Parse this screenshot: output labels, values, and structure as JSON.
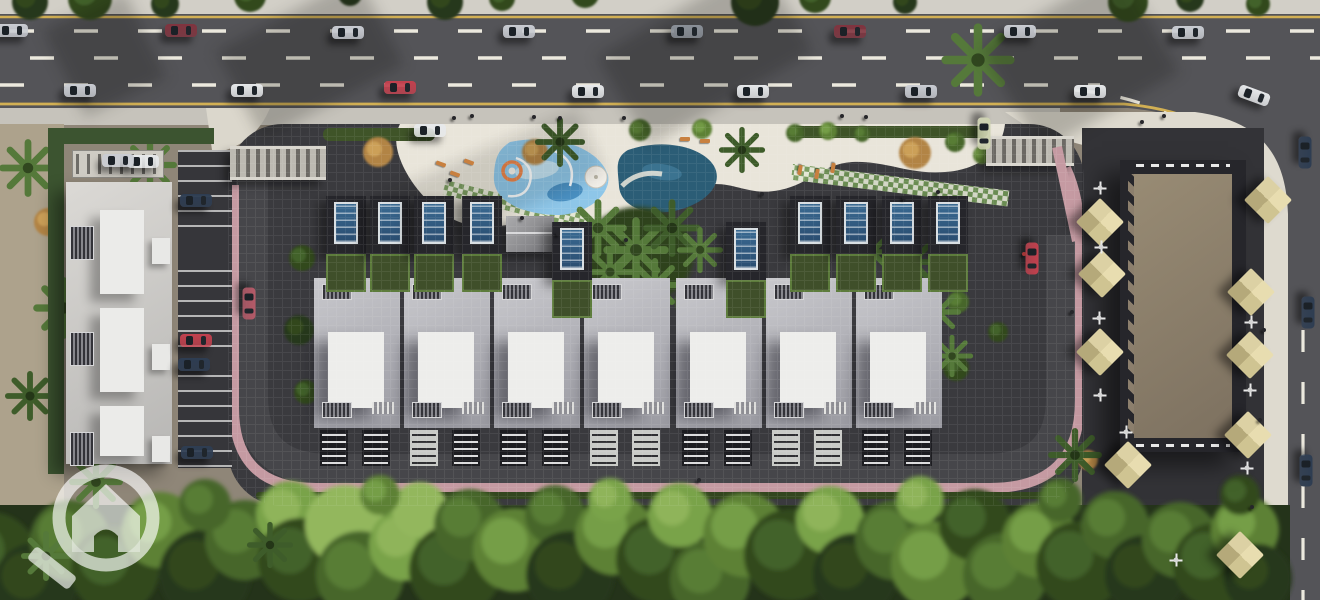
{
  "scene": {
    "title": "Residential compound aerial master-plan 3D render",
    "view": "top-down bird's eye",
    "elements": "main road with traffic, gated villa compound with two pools, apartment block with parking, retail building with cafe umbrellas, tree belt"
  },
  "palette": {
    "road": "#545458",
    "road_service": "#4b4b4f",
    "lane_marking": "#ece9de",
    "edge_line": "#d2b054",
    "sidewalk_top": "#d2cfc7",
    "sidewalk_bottom": "#c6c3bb",
    "walk_wedge": "#dedacf",
    "sand": "#ada28c",
    "compound_paving": "#3a3a3e",
    "inner_road": "#46464a",
    "pink_walk": "#c59aa2",
    "deck": "#e9e5da",
    "hedge": "#3f5428",
    "pool_kids": "#8ec6e8",
    "pool_kids_light": "#c2e2f2",
    "pool_kids_deep": "#4a90c2",
    "pool_main": "#2b5d76",
    "pool_main_light": "#3b7390",
    "checker_a": "#e3e7d4",
    "checker_b": "#6f9554",
    "tree_base": "#24331a",
    "umbrella": "#d8cd9e",
    "watermark": "rgba(255,255,255,0.8)"
  },
  "watermark": {
    "icon": "magnifier-house-logo",
    "position": "bottom-left"
  },
  "main_road": {
    "lanes": 4,
    "orientation": "horizontal",
    "edge_lines": "yellow",
    "lane_dashes": "white"
  },
  "service_road": {
    "orientation": "vertical",
    "position": "right-edge"
  },
  "compound": {
    "gates": 2,
    "villas": {
      "count": 7,
      "y": 278,
      "x_positions": [
        314,
        404,
        494,
        584,
        676,
        766,
        856
      ]
    },
    "solar_units": [
      [
        326,
        196
      ],
      [
        370,
        196
      ],
      [
        414,
        196
      ],
      [
        462,
        196
      ],
      [
        552,
        222
      ],
      [
        726,
        222
      ],
      [
        790,
        196
      ],
      [
        836,
        196
      ],
      [
        882,
        196
      ],
      [
        928,
        196
      ]
    ],
    "pools": [
      {
        "name": "kids-aqua-pool",
        "color": "#8ec6e8",
        "features": [
          "slides",
          "spiral-ring"
        ]
      },
      {
        "name": "main-pool",
        "color": "#2b5d76"
      }
    ],
    "cabana": true,
    "white_parasol": [
      596,
      177
    ]
  },
  "vehicles": {
    "car_colors": [
      "#c9ccd2",
      "#e6e8ea",
      "#80343f",
      "#c2414e",
      "#2e3d52",
      "#8a9098",
      "#cdd2b0",
      "#b55a68"
    ],
    "main_road": [
      [
        12,
        30,
        0,
        0
      ],
      [
        181,
        30,
        0,
        2
      ],
      [
        348,
        32,
        0,
        0
      ],
      [
        519,
        31,
        0,
        0
      ],
      [
        687,
        31,
        0,
        5
      ],
      [
        850,
        31,
        0,
        2
      ],
      [
        1020,
        31,
        0,
        0
      ],
      [
        1188,
        32,
        0,
        0
      ],
      [
        80,
        90,
        0,
        0
      ],
      [
        247,
        90,
        0,
        1
      ],
      [
        400,
        87,
        0,
        3
      ],
      [
        588,
        91,
        0,
        1
      ],
      [
        753,
        91,
        0,
        1
      ],
      [
        921,
        91,
        0,
        0
      ],
      [
        1090,
        91,
        0,
        1
      ],
      [
        1254,
        95,
        20,
        1
      ]
    ],
    "service_road": [
      [
        1305,
        152,
        90,
        4
      ],
      [
        1308,
        312,
        90,
        4
      ],
      [
        1306,
        470,
        90,
        4
      ]
    ],
    "compound": [
      [
        249,
        303,
        90,
        7
      ],
      [
        1032,
        258,
        90,
        3
      ],
      [
        984,
        133,
        90,
        6
      ],
      [
        430,
        130,
        0,
        1
      ]
    ],
    "parking": [
      [
        196,
        200,
        0,
        4
      ],
      [
        196,
        340,
        0,
        3
      ],
      [
        194,
        364,
        0,
        4
      ],
      [
        197,
        452,
        0,
        4
      ],
      [
        143,
        161,
        0,
        1
      ],
      [
        118,
        160,
        0,
        0
      ]
    ]
  },
  "commercial": {
    "roof_color": "#8c7f6d",
    "umbrellas": [
      [
        1100,
        222
      ],
      [
        1102,
        274
      ],
      [
        1100,
        352
      ],
      [
        1128,
        465
      ],
      [
        1251,
        292
      ],
      [
        1250,
        355
      ],
      [
        1248,
        435
      ],
      [
        1240,
        555
      ],
      [
        1268,
        200
      ]
    ],
    "tables": [
      [
        1100,
        188
      ],
      [
        1101,
        247
      ],
      [
        1099,
        318
      ],
      [
        1100,
        395
      ],
      [
        1126,
        432
      ],
      [
        1251,
        322
      ],
      [
        1250,
        390
      ],
      [
        1247,
        468
      ],
      [
        1176,
        560
      ]
    ]
  },
  "people": [
    [
      452,
      116,
      0
    ],
    [
      470,
      114,
      0
    ],
    [
      532,
      115,
      0
    ],
    [
      558,
      116,
      0
    ],
    [
      622,
      116,
      0
    ],
    [
      840,
      114,
      0
    ],
    [
      864,
      115,
      0
    ],
    [
      1162,
      114,
      0
    ],
    [
      448,
      178,
      0
    ],
    [
      520,
      216,
      0
    ],
    [
      556,
      232,
      0
    ],
    [
      624,
      238,
      0
    ],
    [
      760,
      192,
      0
    ],
    [
      902,
      196,
      0
    ],
    [
      1022,
      252,
      1
    ],
    [
      1070,
      310,
      0
    ],
    [
      1262,
      328,
      0
    ],
    [
      1258,
      418,
      0
    ],
    [
      1250,
      505,
      0
    ],
    [
      697,
      478,
      0
    ],
    [
      1140,
      120,
      0
    ],
    [
      936,
      190,
      0
    ]
  ],
  "loungers": [
    [
      436,
      162,
      20
    ],
    [
      450,
      172,
      20
    ],
    [
      464,
      160,
      20
    ],
    [
      795,
      168,
      100
    ],
    [
      812,
      172,
      100
    ],
    [
      828,
      166,
      100
    ],
    [
      680,
      137,
      0
    ],
    [
      700,
      139,
      0
    ]
  ],
  "vegetation": {
    "tree_colors": [
      "#26381b",
      "#33491f",
      "#47662b",
      "#5d8136",
      "#79a349",
      "#93b75d"
    ],
    "autumn_color": "#b28445",
    "bottom_trees": [
      [
        -10,
        560,
        48,
        1
      ],
      [
        35,
        585,
        42,
        0
      ],
      [
        70,
        540,
        40,
        2
      ],
      [
        115,
        570,
        44,
        1
      ],
      [
        160,
        530,
        38,
        3
      ],
      [
        205,
        575,
        46,
        0
      ],
      [
        245,
        540,
        40,
        2
      ],
      [
        290,
        515,
        34,
        4
      ],
      [
        300,
        560,
        42,
        1
      ],
      [
        345,
        525,
        40,
        5
      ],
      [
        360,
        575,
        44,
        2
      ],
      [
        405,
        545,
        36,
        4
      ],
      [
        420,
        510,
        28,
        5
      ],
      [
        455,
        570,
        46,
        1
      ],
      [
        470,
        525,
        36,
        2
      ],
      [
        515,
        550,
        42,
        3
      ],
      [
        555,
        515,
        30,
        2
      ],
      [
        570,
        575,
        44,
        0
      ],
      [
        615,
        535,
        40,
        3
      ],
      [
        660,
        560,
        44,
        1
      ],
      [
        680,
        515,
        32,
        4
      ],
      [
        710,
        580,
        40,
        2
      ],
      [
        745,
        535,
        42,
        3
      ],
      [
        790,
        555,
        46,
        1
      ],
      [
        830,
        520,
        34,
        4
      ],
      [
        855,
        575,
        42,
        0
      ],
      [
        895,
        540,
        40,
        2
      ],
      [
        935,
        565,
        44,
        3
      ],
      [
        975,
        525,
        36,
        1
      ],
      [
        1005,
        575,
        42,
        2
      ],
      [
        1040,
        540,
        38,
        3
      ],
      [
        1080,
        565,
        44,
        1
      ],
      [
        1115,
        525,
        34,
        2
      ],
      [
        1145,
        575,
        40,
        0
      ],
      [
        1180,
        540,
        38,
        2
      ],
      [
        1215,
        565,
        42,
        1
      ],
      [
        1245,
        530,
        34,
        3
      ],
      [
        1258,
        578,
        34,
        0
      ],
      [
        920,
        500,
        24,
        4
      ],
      [
        610,
        500,
        22,
        4
      ],
      [
        380,
        495,
        20,
        3
      ],
      [
        205,
        505,
        26,
        2
      ],
      [
        1060,
        500,
        22,
        2
      ],
      [
        1240,
        495,
        20,
        1
      ]
    ],
    "top_trees": [
      [
        30,
        2,
        18,
        0
      ],
      [
        90,
        -2,
        22,
        1
      ],
      [
        165,
        4,
        14,
        0
      ],
      [
        250,
        -4,
        16,
        1
      ],
      [
        350,
        -6,
        12,
        0
      ],
      [
        445,
        2,
        18,
        0
      ],
      [
        502,
        -2,
        13,
        1
      ],
      [
        585,
        -6,
        14,
        1
      ],
      [
        755,
        2,
        24,
        0
      ],
      [
        815,
        -3,
        16,
        1
      ],
      [
        905,
        2,
        12,
        0
      ],
      [
        1128,
        2,
        20,
        1
      ],
      [
        1190,
        -2,
        14,
        0
      ],
      [
        1258,
        4,
        12,
        1
      ]
    ],
    "inner_trees": [
      [
        302,
        258,
        13,
        1
      ],
      [
        299,
        330,
        15,
        0
      ],
      [
        306,
        392,
        12,
        1
      ],
      [
        688,
        302,
        13,
        2
      ],
      [
        690,
        360,
        11,
        1
      ],
      [
        958,
        302,
        11,
        2
      ],
      [
        956,
        368,
        13,
        1
      ],
      [
        998,
        332,
        10,
        1
      ],
      [
        795,
        133,
        9,
        2
      ],
      [
        828,
        131,
        9,
        3
      ],
      [
        862,
        134,
        8,
        2
      ],
      [
        955,
        142,
        10,
        2
      ],
      [
        982,
        155,
        9,
        3
      ],
      [
        640,
        130,
        11,
        2
      ],
      [
        702,
        129,
        10,
        3
      ]
    ],
    "autumn_trees": [
      [
        378,
        152,
        15
      ],
      [
        535,
        152,
        13
      ],
      [
        915,
        153,
        16
      ],
      [
        1088,
        460,
        10
      ],
      [
        48,
        222,
        14
      ],
      [
        105,
        258,
        15
      ]
    ],
    "palms": [
      [
        28,
        168,
        1.5
      ],
      [
        64,
        308,
        1.6
      ],
      [
        30,
        396,
        1.3
      ],
      [
        96,
        482,
        1.4
      ],
      [
        46,
        556,
        1.3
      ],
      [
        270,
        545,
        1.2
      ],
      [
        150,
        165,
        1.4
      ],
      [
        978,
        60,
        1.9
      ],
      [
        560,
        142,
        1.3
      ],
      [
        598,
        228,
        1.5
      ],
      [
        636,
        250,
        1.7
      ],
      [
        672,
        228,
        1.5
      ],
      [
        655,
        285,
        1.4
      ],
      [
        610,
        272,
        1.3
      ],
      [
        742,
        150,
        1.2
      ],
      [
        700,
        250,
        1.2
      ],
      [
        872,
        252,
        1.2
      ],
      [
        912,
        262,
        1.3
      ],
      [
        938,
        312,
        1.2
      ],
      [
        952,
        356,
        1.1
      ],
      [
        1075,
        455,
        1.4
      ]
    ]
  }
}
